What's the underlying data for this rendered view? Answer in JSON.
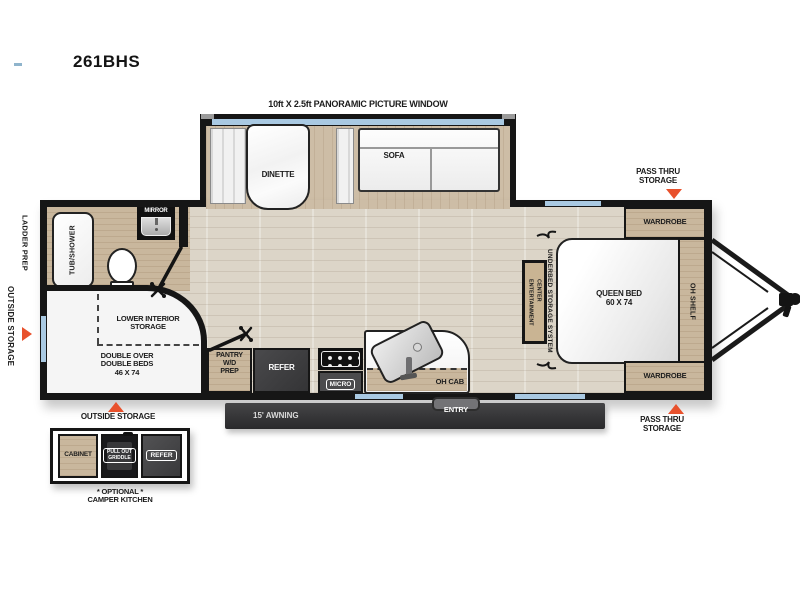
{
  "title": "261BHS",
  "slide": {
    "window_label": "10ft X 2.5ft PANORAMIC PICTURE WINDOW",
    "dinette": "DINETTE",
    "sofa": "SOFA"
  },
  "bathroom": {
    "tub_shower": "TUB/SHOWER",
    "mirror": "MIRROR"
  },
  "bunk_room": {
    "lower_interior_storage": "LOWER INTERIOR\nSTORAGE",
    "double_beds": "DOUBLE OVER\nDOUBLE BEDS\n46 X 74"
  },
  "kitchen": {
    "pantry": "PANTRY\nW/D\nPREP",
    "refer": "REFER",
    "micro": "MICRO",
    "oh_cab": "OH CAB"
  },
  "bedroom": {
    "wardrobe_top": "WARDROBE",
    "wardrobe_bottom": "WARDROBE",
    "queen_bed": "QUEEN BED\n60 X 74",
    "oh_shelf": "OH SHELF",
    "underbed": "UNDERBED STORAGE SYSTEM",
    "entertainment": "ENTERTAINMENT\nCENTER"
  },
  "exterior": {
    "ladder_prep": "LADDER PREP",
    "outside_storage_left": "OUTSIDE STORAGE",
    "outside_storage_bottom": "OUTSIDE STORAGE",
    "pass_thru_top": "PASS THRU\nSTORAGE",
    "pass_thru_bottom": "PASS THRU\nSTORAGE",
    "awning": "15' AWNING",
    "entry": "ENTRY"
  },
  "camper_kitchen": {
    "cabinet": "CABINET",
    "griddle": "PULL OUT\nGRIDDLE",
    "refer": "REFER",
    "caption": "* OPTIONAL *\nCAMPER KITCHEN"
  },
  "colors": {
    "accent_orange": "#E8512C",
    "window_blue": "#A9C9E2",
    "wall_black": "#161616",
    "floor_light": "#DCD5C8",
    "wood_tan": "#C9B79D",
    "appliance_dark": "#3E3E40"
  }
}
